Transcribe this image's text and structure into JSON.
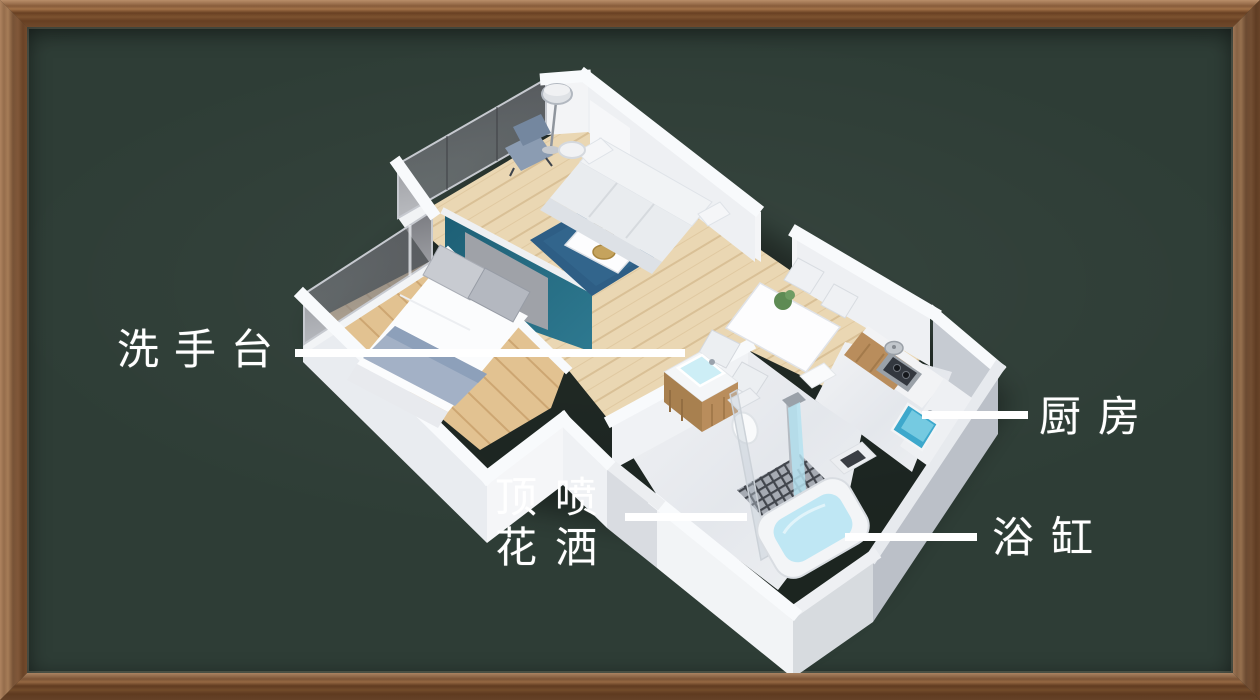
{
  "board": {
    "background_color": "#2e3d36",
    "frame_wood_color": "#8a5a36"
  },
  "annotations": {
    "washbasin": {
      "label": "洗手台"
    },
    "kitchen": {
      "label": "厨房"
    },
    "shower": {
      "line1": "顶喷",
      "line2": "花洒"
    },
    "bathtub": {
      "label": "浴缸"
    }
  },
  "palette": {
    "label_color": "#ffffff",
    "leader_line_color": "#ffffff",
    "accent_wall_teal": "#20657c",
    "rug_blue": "#2e5e85",
    "bathtub_water": "#c2e8f5",
    "kitchen_sink_blue": "#3da8cc",
    "living_wood_floor": "#ead7b3",
    "bedroom_wood_floor": "#e2c291",
    "cabinet_wood": "#b98d5c",
    "marble_floor": "#eceef0",
    "wall_white": "#f7f9fb"
  }
}
